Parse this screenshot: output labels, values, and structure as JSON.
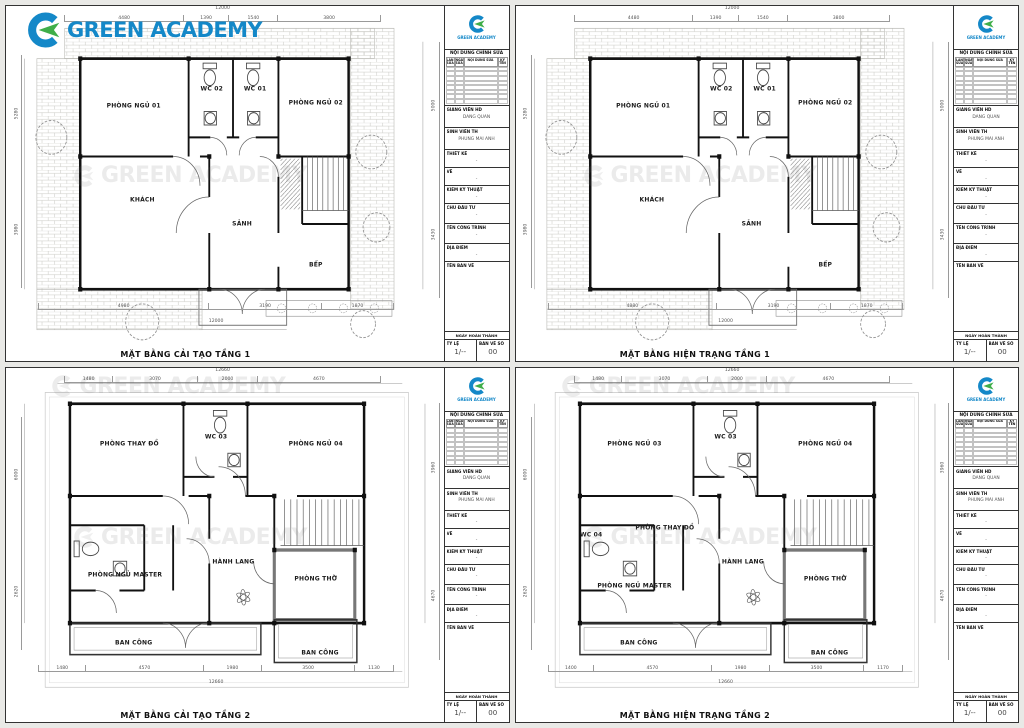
{
  "logo": {
    "text": "GREEN ACADEMY",
    "brand_blue": "#1488c8",
    "brand_green": "#3fae49"
  },
  "watermark": {
    "text": "GREEN ACADEMY"
  },
  "titleblock": {
    "revision_header": "NỘI DUNG CHỈNH SỬA",
    "revision_columns": [
      "LẦN SỬA",
      "NGÀY SỬA",
      "NỘI DUNG SỬA",
      "KÝ TÊN"
    ],
    "gvhd_label": "GIẢNG VIÊN HD",
    "gvhd_value": "DANG QUAN",
    "svth_label": "SINH VIÊN TH",
    "svth_value": "PHUNG MAI ANH",
    "thietke_label": "THIẾT KẾ",
    "thietke_value": "-",
    "ve_label": "VẼ",
    "ve_value": "-",
    "kythuat_label": "KIỂM KỸ THUẬT",
    "kythuat_value": "-",
    "chudautu_label": "CHỦ ĐẦU TƯ",
    "chudautu_value": "-",
    "congtrinh_label": "TÊN CÔNG TRÌNH",
    "congtrinh_value": "-",
    "diadiem_label": "ĐỊA ĐIỂM",
    "diadiem_value": "-",
    "tenbanve_label": "TÊN BẢN VẼ",
    "footer_label": "NGÀY HOÀN THÀNH",
    "tyle_label": "TỶ LỆ",
    "tyle_value": "1/--",
    "banveso_label": "BẢN VẼ SỐ",
    "banveso_value": "00"
  },
  "sheets": [
    {
      "title": "MẶT BẰNG CẢI TẠO TẦNG 1",
      "dim_overall_top": "12000",
      "dim_overall_bottom": "12000",
      "dims_top": [
        "4480",
        "1390",
        "1540",
        "3800"
      ],
      "dims_bottom": [
        "4980",
        "3190",
        "1870"
      ],
      "dims_left": [
        "5280",
        "3980"
      ],
      "dims_right": [
        "5000",
        "3430"
      ],
      "rooms": [
        {
          "t": "PHÒNG NGỦ 01",
          "x": 29,
          "y": 29
        },
        {
          "t": "WC 02",
          "x": 47,
          "y": 24
        },
        {
          "t": "WC 01",
          "x": 57,
          "y": 24
        },
        {
          "t": "PHÒNG NGỦ 02",
          "x": 71,
          "y": 28
        },
        {
          "t": "KHÁCH",
          "x": 31,
          "y": 57
        },
        {
          "t": "SẢNH",
          "x": 54,
          "y": 64
        },
        {
          "t": "BẾP",
          "x": 71,
          "y": 76
        }
      ]
    },
    {
      "title": "MẶT BẰNG HIỆN TRẠNG TẦNG 1",
      "dim_overall_top": "12000",
      "dim_overall_bottom": "12000",
      "dims_top": [
        "4480",
        "1390",
        "1540",
        "3800"
      ],
      "dims_bottom": [
        "4880",
        "3190",
        "1870"
      ],
      "dims_left": [
        "5280",
        "3980"
      ],
      "dims_right": [
        "5000",
        "3430"
      ],
      "rooms": [
        {
          "t": "PHÒNG NGỦ 01",
          "x": 29,
          "y": 29
        },
        {
          "t": "WC 02",
          "x": 47,
          "y": 24
        },
        {
          "t": "WC 01",
          "x": 57,
          "y": 24
        },
        {
          "t": "PHÒNG NGỦ 02",
          "x": 71,
          "y": 28
        },
        {
          "t": "KHÁCH",
          "x": 31,
          "y": 57
        },
        {
          "t": "SẢNH",
          "x": 54,
          "y": 64
        },
        {
          "t": "BẾP",
          "x": 71,
          "y": 76
        }
      ]
    },
    {
      "title": "MẶT BẰNG CẢI TẠO TẦNG 2",
      "dim_overall_top": "12660",
      "dim_overall_bottom": "12660",
      "dims_top": [
        "1480",
        "3070",
        "2000",
        "4670"
      ],
      "dims_bottom": [
        "1480",
        "4570",
        "1980",
        "3500",
        "1130"
      ],
      "dims_left": [
        "6000",
        "2620"
      ],
      "dims_right": [
        "3960",
        "4670"
      ],
      "rooms": [
        {
          "t": "PHÒNG THAY ĐỒ",
          "x": 28,
          "y": 22
        },
        {
          "t": "WC 03",
          "x": 48,
          "y": 20
        },
        {
          "t": "PHÒNG NGỦ 04",
          "x": 71,
          "y": 22
        },
        {
          "t": "HÀNH LANG",
          "x": 52,
          "y": 57
        },
        {
          "t": "PHÒNG NGỦ MASTER",
          "x": 27,
          "y": 61
        },
        {
          "t": "PHÒNG THỜ",
          "x": 71,
          "y": 62
        },
        {
          "t": "BAN CÔNG",
          "x": 29,
          "y": 81
        },
        {
          "t": "BAN CÔNG",
          "x": 72,
          "y": 84
        }
      ]
    },
    {
      "title": "MẶT BẰNG HIỆN TRẠNG TẦNG 2",
      "dim_overall_top": "12660",
      "dim_overall_bottom": "12660",
      "dims_top": [
        "1480",
        "3070",
        "2000",
        "4670"
      ],
      "dims_bottom": [
        "1400",
        "4570",
        "1980",
        "3500",
        "1170"
      ],
      "dims_left": [
        "6000",
        "2620"
      ],
      "dims_right": [
        "3960",
        "4670"
      ],
      "rooms": [
        {
          "t": "PHÒNG NGỦ 03",
          "x": 27,
          "y": 22
        },
        {
          "t": "WC 03",
          "x": 48,
          "y": 20
        },
        {
          "t": "PHÒNG NGỦ 04",
          "x": 71,
          "y": 22
        },
        {
          "t": "WC 04",
          "x": 17,
          "y": 49
        },
        {
          "t": "PHÒNG THAY ĐỒ",
          "x": 34,
          "y": 47
        },
        {
          "t": "HÀNH LANG",
          "x": 52,
          "y": 57
        },
        {
          "t": "PHÒNG NGỦ MASTER",
          "x": 27,
          "y": 64
        },
        {
          "t": "PHÒNG THỜ",
          "x": 71,
          "y": 62
        },
        {
          "t": "BAN CÔNG",
          "x": 28,
          "y": 81
        },
        {
          "t": "BAN CÔNG",
          "x": 72,
          "y": 84
        }
      ]
    }
  ]
}
